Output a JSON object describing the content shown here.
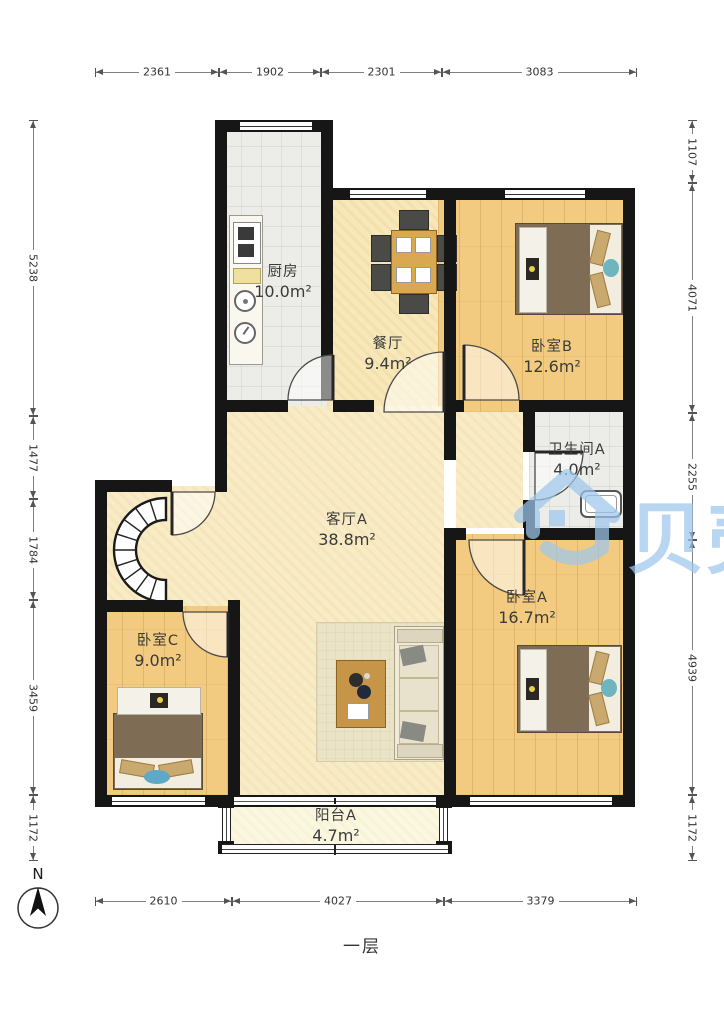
{
  "floor_label": "一层",
  "north_label": "N",
  "watermark": {
    "text": "贝壳",
    "color": "#9EC7EC"
  },
  "rooms": [
    {
      "name": "厨房",
      "area": "10.0m²"
    },
    {
      "name": "餐厅",
      "area": "9.4m²"
    },
    {
      "name": "卧室B",
      "area": "12.6m²"
    },
    {
      "name": "卫生间A",
      "area": "4.0m²"
    },
    {
      "name": "客厅A",
      "area": "38.8m²"
    },
    {
      "name": "卧室A",
      "area": "16.7m²"
    },
    {
      "name": "卧室C",
      "area": "9.0m²"
    },
    {
      "name": "阳台A",
      "area": "4.7m²"
    }
  ],
  "dimensions": {
    "top": [
      "2361",
      "1902",
      "2301",
      "3083"
    ],
    "left": [
      "5238",
      "1477",
      "1784",
      "3459",
      "1172"
    ],
    "right": [
      "1107",
      "4071",
      "2255",
      "4939",
      "1172"
    ],
    "bottom": [
      "2610",
      "4027",
      "3379"
    ]
  },
  "icons": {
    "north_arrow": "compass-north",
    "stairs": "spiral-staircase",
    "beds": "double-bed",
    "sofa": "sofa",
    "table": "dining-table",
    "stove": "stove",
    "sink": "sink",
    "tub": "washbasin",
    "logo": "beike-house-logo"
  }
}
